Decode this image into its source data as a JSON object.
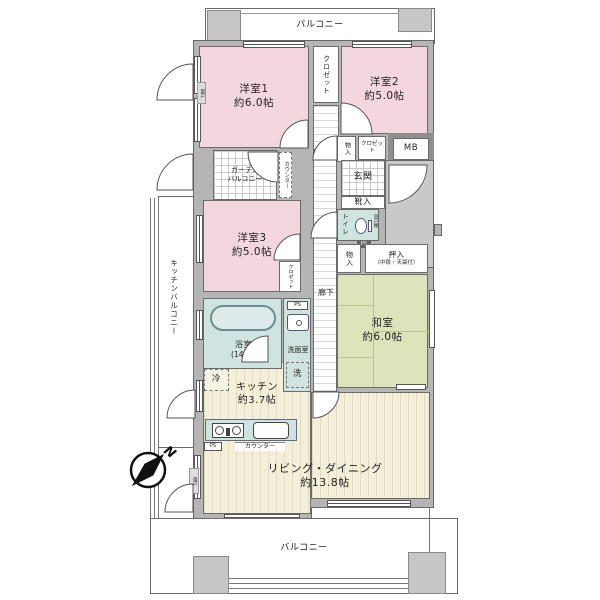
{
  "colors": {
    "wall_gray": "#b5b5b5",
    "room_pink": "#f4d6df",
    "tatami_green": "#dde4bc",
    "wet_area_teal": "#cfe4e1",
    "floor_cream": "#f4efd9",
    "porch_gray": "#c9c9c9"
  },
  "balconies": {
    "top": "バルコニー",
    "bottom": "バルコニー",
    "kitchen": "キッチンバルコニー",
    "garden_line1": "ガーデン",
    "garden_line2": "バルコニー"
  },
  "rooms": {
    "western1": {
      "name": "洋室1",
      "size": "約6.0帖"
    },
    "western2": {
      "name": "洋室2",
      "size": "約5.0帖"
    },
    "western3": {
      "name": "洋室3",
      "size": "約5.0帖"
    },
    "japanese": {
      "name": "和室",
      "size": "約6.0帖"
    },
    "kitchen": {
      "name": "キッチン",
      "size": "約3.7帖"
    },
    "living_dining": {
      "name": "リビング・ダイニング",
      "size": "約13.8帖"
    },
    "bath": {
      "name": "浴室",
      "size": "(1418)"
    },
    "washroom": {
      "name": "洗面室"
    },
    "toilet": {
      "name": "トイレ"
    },
    "entrance": {
      "name": "玄関"
    },
    "corridor": {
      "name": "廊下"
    }
  },
  "storage": {
    "closet_top": "クロゼット",
    "closet_entry": "クロゼット",
    "closet_w3": "クロゼット",
    "monoire_entry": "物入",
    "monoire_hall": "物入",
    "oshiire": "押入",
    "oshiire_note": "（中段・天袋付）",
    "shoe_box": "靴入",
    "meter_box": "MB",
    "hanging_shelf": "吊戸棚"
  },
  "fixtures": {
    "washer": "洗",
    "fridge": "冷",
    "counter_hall": "カウンター",
    "counter_kitchen": "カウンター",
    "ps_washroom": "PS",
    "ps_toilet": "PS",
    "ps_kitchen": "PS",
    "shutter_upper": "雨戸",
    "shutter_lower": "雨戸"
  },
  "compass": {
    "north": "N"
  }
}
